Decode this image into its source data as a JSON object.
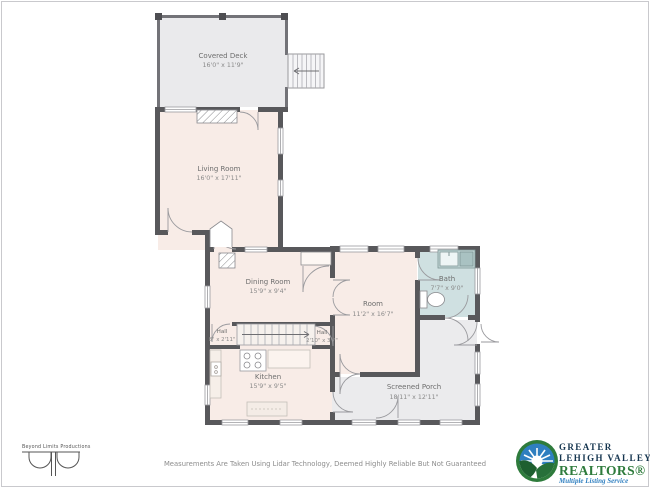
{
  "floorplan": {
    "rooms": [
      {
        "id": "covered-deck",
        "name": "Covered Deck",
        "dims": "16'0\" x 11'9\""
      },
      {
        "id": "living-room",
        "name": "Living Room",
        "dims": "16'0\" x 17'11\""
      },
      {
        "id": "dining-room",
        "name": "Dining Room",
        "dims": "15'9\" x 9'4\""
      },
      {
        "id": "hall-left",
        "name": "Hall",
        "dims": "8\" x 2'11\""
      },
      {
        "id": "hall-right",
        "name": "Hall",
        "dims": "2'10\" x 3'7\""
      },
      {
        "id": "room",
        "name": "Room",
        "dims": "11'2\" x 16'7\""
      },
      {
        "id": "bath",
        "name": "Bath",
        "dims": "7'7\" x 9'0\""
      },
      {
        "id": "kitchen",
        "name": "Kitchen",
        "dims": "15'9\" x 9'5\""
      },
      {
        "id": "screened-porch",
        "name": "Screened Porch",
        "dims": "18'11\" x 12'11\""
      }
    ],
    "colors": {
      "wall": "#58585b",
      "interior": "#f8ece7",
      "deck_porch": "#eaeaec",
      "bath": "#cfe0e1"
    }
  },
  "footer": {
    "disclaimer": "Measurements Are Taken Using Lidar Technology, Deemed Highly Reliable But Not Guaranteed",
    "producer": "Beyond Limits Productions"
  },
  "realtor_logo": {
    "line1": "GREATER",
    "line2": "LEHIGH VALLEY",
    "line3": "REALTORS®",
    "line4": "Multiple Listing Service",
    "navy": "#15354f",
    "green": "#2e7b3c",
    "blue": "#2f7fc0"
  }
}
